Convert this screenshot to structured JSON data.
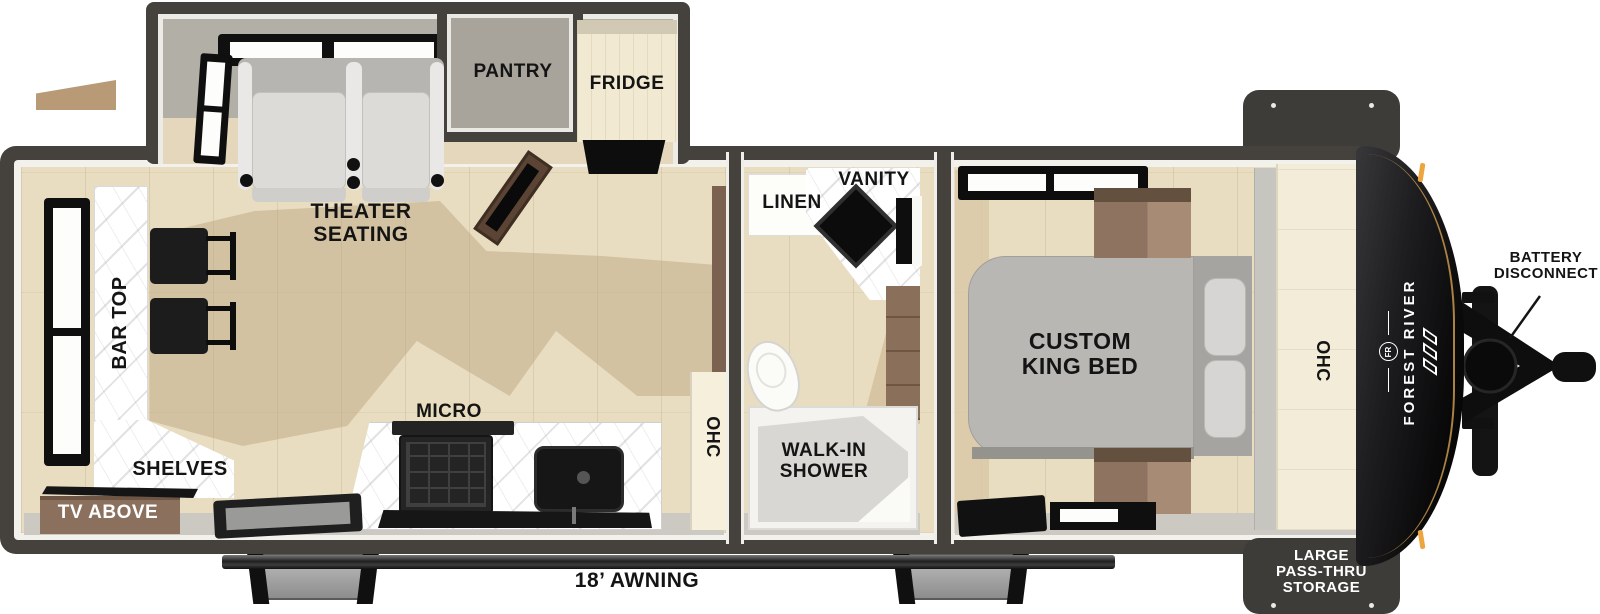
{
  "title": "Travel trailer floor plan",
  "labels": {
    "pantry": "PANTRY",
    "fridge": "FRIDGE",
    "theater_seating": "THEATER\nSEATING",
    "bar_top": "BAR TOP",
    "shelves": "SHELVES",
    "tv_above": "TV ABOVE",
    "micro": "MICRO",
    "kitchen_ohc": "OHC",
    "linen": "LINEN",
    "vanity": "VANITY",
    "walk_in_shower": "WALK-IN\nSHOWER",
    "custom_king_bed": "CUSTOM\nKING BED",
    "bedroom_ohc": "OHC",
    "awning": "18’ AWNING",
    "battery_disconnect": "BATTERY\nDISCONNECT",
    "pass_thru_storage": "LARGE\nPASS-THRU\nSTORAGE"
  },
  "brand": {
    "name": "FOREST RIVER",
    "medallion": "FR"
  },
  "colors": {
    "wall": "#45423e",
    "floor_wood": "#e9ddc1",
    "marker_amber": "#eca63f",
    "front_cap": "#0d0d0e",
    "label_text": "#141414",
    "storage_box": "#3d3c39"
  }
}
